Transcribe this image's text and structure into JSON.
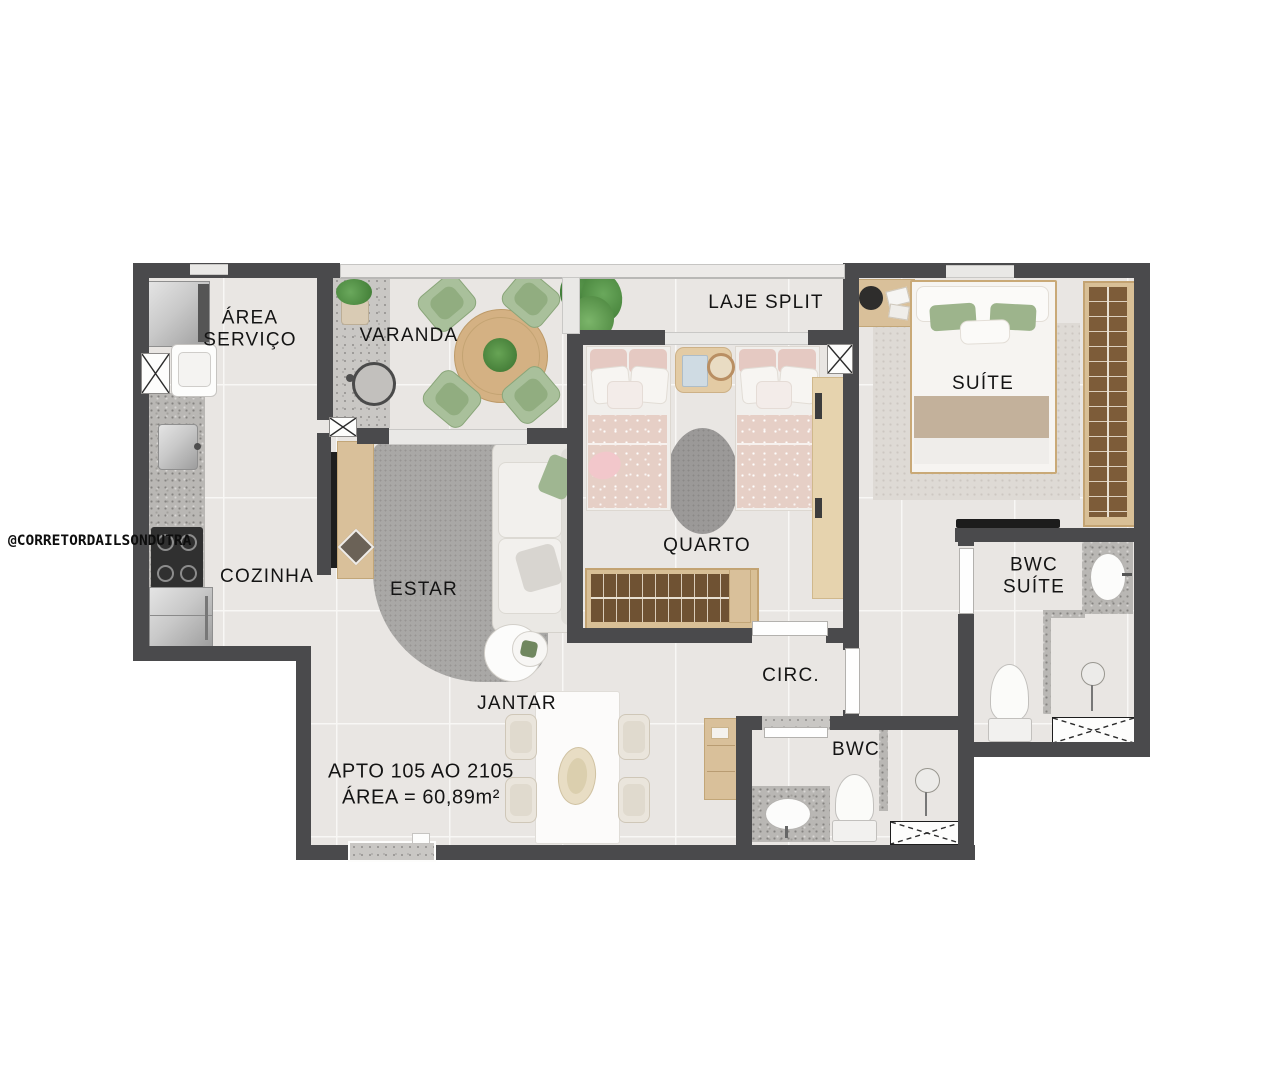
{
  "floorplan": {
    "watermark": "@CORRETORDAILSONDUTRA",
    "unit": {
      "apto_line": "APTO 105 AO 2105",
      "area_line": "ÁREA = 60,89m²"
    },
    "rooms": {
      "area_servico": {
        "label": "ÁREA\nSERVIÇO"
      },
      "varanda": {
        "label": "VARANDA"
      },
      "laje_split": {
        "label": "LAJE SPLIT"
      },
      "cozinha": {
        "label": "COZINHA"
      },
      "estar": {
        "label": "ESTAR"
      },
      "jantar": {
        "label": "JANTAR"
      },
      "quarto": {
        "label": "QUARTO"
      },
      "suite": {
        "label": "SUÍTE"
      },
      "bwc_suite": {
        "label": "BWC\nSUÍTE"
      },
      "circ": {
        "label": "CIRC."
      },
      "bwc": {
        "label": "BWC"
      }
    },
    "colors": {
      "wall": "#4a4a4c",
      "floor_tile": "#e9e6e3",
      "grout": "#f8f7f5",
      "counter_granite": "#b9b7b4",
      "balcony_granite": "#c9c7c4",
      "wood_light": "#d9c09a",
      "wood_dark_interior": "#6f5233",
      "sage_green": "#a9c09b",
      "plant_green": "#4c8a3f",
      "blanket_pink": "#e6cfc6",
      "blanket_beige": "#c3b19b",
      "rug_gray": "#a9a8a6",
      "suite_rug": "#dedad5",
      "label_text": "#141414"
    }
  }
}
